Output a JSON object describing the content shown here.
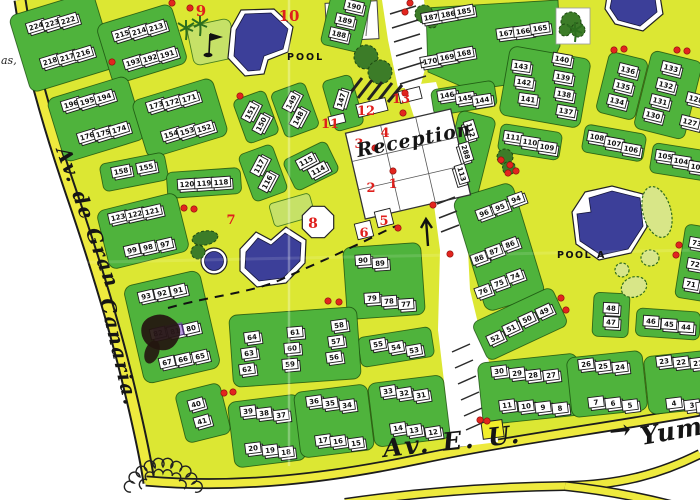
{
  "map": {
    "labels": [
      {
        "t": "POOL",
        "x": 287,
        "y": 60,
        "s": 9.5,
        "r": 0,
        "c": "print",
        "ls": 2
      },
      {
        "t": "POOL A",
        "x": 557,
        "y": 258,
        "s": 9.5,
        "r": 0,
        "c": "print",
        "ls": 1.5
      },
      {
        "t": "Av. de Gran",
        "x": 56,
        "y": 150,
        "s": 20,
        "r": 70,
        "c": "hand",
        "ls": 2
      },
      {
        "t": "Canaria.",
        "x": 100,
        "y": 300,
        "s": 20,
        "r": 77,
        "c": "hand",
        "ls": 2
      },
      {
        "t": "Reception",
        "x": 358,
        "y": 157,
        "s": 19,
        "r": -11,
        "c": "hand",
        "ls": 1
      },
      {
        "t": "Av. E. U.",
        "x": 384,
        "y": 457,
        "s": 25,
        "r": -6,
        "c": "hand",
        "ls": 3
      },
      {
        "t": "Yumbo",
        "x": 642,
        "y": 445,
        "s": 25,
        "r": -10,
        "c": "hand",
        "ls": 1
      },
      {
        "t": "→",
        "x": 610,
        "y": 440,
        "s": 26,
        "r": -6,
        "c": "hand",
        "ls": 0
      },
      {
        "t": "as,",
        "x": 1,
        "y": 64,
        "s": 11,
        "r": 0,
        "c": "print-it",
        "ls": 0
      }
    ],
    "red_numbers": [
      {
        "t": "1",
        "x": 393,
        "y": 188,
        "s": 13
      },
      {
        "t": "2",
        "x": 371,
        "y": 192,
        "s": 13
      },
      {
        "t": "3",
        "x": 359,
        "y": 148,
        "s": 13
      },
      {
        "t": "4",
        "x": 385,
        "y": 137,
        "s": 13
      },
      {
        "t": "5",
        "x": 384,
        "y": 225,
        "s": 13
      },
      {
        "t": "6",
        "x": 364,
        "y": 237,
        "s": 13
      },
      {
        "t": "7",
        "x": 231,
        "y": 224,
        "s": 13
      },
      {
        "t": "8",
        "x": 313,
        "y": 228,
        "s": 14
      },
      {
        "t": "9",
        "x": 201,
        "y": 16,
        "s": 15
      },
      {
        "t": "10",
        "x": 289,
        "y": 21,
        "s": 15
      },
      {
        "t": "11",
        "x": 330,
        "y": 128,
        "s": 13
      },
      {
        "t": "12",
        "x": 366,
        "y": 115,
        "s": 13
      },
      {
        "t": "13",
        "x": 401,
        "y": 103,
        "s": 13
      }
    ],
    "red_dots": [
      [
        172,
        3
      ],
      [
        190,
        8
      ],
      [
        405,
        12
      ],
      [
        410,
        3
      ],
      [
        112,
        62
      ],
      [
        240,
        96
      ],
      [
        614,
        50
      ],
      [
        624,
        49
      ],
      [
        677,
        50
      ],
      [
        687,
        51
      ],
      [
        405,
        93
      ],
      [
        433,
        205
      ],
      [
        398,
        228
      ],
      [
        375,
        148
      ],
      [
        393,
        171
      ],
      [
        403,
        113
      ],
      [
        501,
        160
      ],
      [
        510,
        165
      ],
      [
        508,
        173
      ],
      [
        516,
        171
      ],
      [
        184,
        208
      ],
      [
        194,
        209
      ],
      [
        328,
        301
      ],
      [
        339,
        302
      ],
      [
        450,
        254
      ],
      [
        561,
        298
      ],
      [
        566,
        310
      ],
      [
        679,
        245
      ],
      [
        676,
        255
      ],
      [
        224,
        393
      ],
      [
        233,
        392
      ],
      [
        480,
        420
      ],
      [
        487,
        421
      ]
    ],
    "buildings": [
      [
        "224",
        36,
        26,
        -17
      ],
      [
        "223",
        52,
        23,
        -17
      ],
      [
        "222",
        68,
        20,
        -17
      ],
      [
        "218",
        50,
        61,
        -17
      ],
      [
        "217",
        67,
        57,
        -17
      ],
      [
        "216",
        83,
        53,
        -17
      ],
      [
        "215",
        122,
        34,
        -17
      ],
      [
        "214",
        139,
        31,
        -17
      ],
      [
        "213",
        156,
        27,
        -17
      ],
      [
        "193",
        133,
        62,
        -17
      ],
      [
        "192",
        150,
        58,
        -17
      ],
      [
        "191",
        167,
        54,
        -17
      ],
      [
        "196",
        71,
        104,
        -17
      ],
      [
        "195",
        87,
        101,
        -17
      ],
      [
        "194",
        104,
        97,
        -17
      ],
      [
        "176",
        87,
        136,
        -17
      ],
      [
        "175",
        103,
        133,
        -17
      ],
      [
        "174",
        119,
        129,
        -17
      ],
      [
        "173",
        156,
        105,
        -17
      ],
      [
        "172",
        172,
        102,
        -17
      ],
      [
        "171",
        189,
        98,
        -17
      ],
      [
        "154",
        171,
        134,
        -17
      ],
      [
        "153",
        187,
        131,
        -17
      ],
      [
        "152",
        204,
        128,
        -17
      ],
      [
        "158",
        121,
        171,
        -11
      ],
      [
        "155",
        146,
        167,
        -11
      ],
      [
        "120",
        187,
        184,
        -4
      ],
      [
        "119",
        204,
        183,
        -4
      ],
      [
        "118",
        221,
        182,
        -4
      ],
      [
        "123",
        118,
        217,
        -13
      ],
      [
        "122",
        135,
        214,
        -13
      ],
      [
        "121",
        152,
        211,
        -13
      ],
      [
        "99",
        132,
        250,
        -13
      ],
      [
        "98",
        148,
        247,
        -13
      ],
      [
        "97",
        165,
        244,
        -13
      ],
      [
        "93",
        146,
        296,
        -13
      ],
      [
        "92",
        162,
        293,
        -13
      ],
      [
        "91",
        178,
        290,
        -13
      ],
      [
        "82",
        158,
        333,
        -13
      ],
      [
        "81",
        175,
        331,
        -13
      ],
      [
        "80",
        191,
        328,
        -13
      ],
      [
        "67",
        167,
        362,
        -13
      ],
      [
        "66",
        183,
        359,
        -13
      ],
      [
        "65",
        200,
        356,
        -13
      ],
      [
        "40",
        196,
        404,
        -16
      ],
      [
        "41",
        202,
        421,
        -16
      ],
      [
        "151",
        250,
        112,
        -62
      ],
      [
        "150",
        261,
        124,
        -62
      ],
      [
        "149",
        291,
        102,
        -62
      ],
      [
        "148",
        298,
        118,
        -62
      ],
      [
        "147",
        341,
        100,
        -73
      ],
      [
        "117",
        259,
        166,
        -62
      ],
      [
        "116",
        267,
        182,
        -62
      ],
      [
        "115",
        306,
        161,
        -28
      ],
      [
        "114",
        318,
        170,
        -28
      ],
      [
        "190",
        354,
        6,
        13
      ],
      [
        "189",
        345,
        20,
        13
      ],
      [
        "188",
        339,
        34,
        13
      ],
      [
        "187",
        431,
        17,
        -10
      ],
      [
        "186",
        448,
        14,
        -10
      ],
      [
        "185",
        464,
        11,
        -10
      ],
      [
        "167",
        506,
        33,
        -8
      ],
      [
        "166",
        523,
        31,
        -8
      ],
      [
        "165",
        540,
        28,
        -8
      ],
      [
        "170",
        430,
        61,
        -10
      ],
      [
        "169",
        447,
        57,
        -10
      ],
      [
        "168",
        464,
        53,
        -10
      ],
      [
        "143",
        521,
        66,
        8
      ],
      [
        "142",
        524,
        82,
        8
      ],
      [
        "141",
        528,
        99,
        8
      ],
      [
        "140",
        562,
        59,
        10
      ],
      [
        "139",
        563,
        77,
        10
      ],
      [
        "138",
        564,
        94,
        10
      ],
      [
        "137",
        566,
        111,
        10
      ],
      [
        "146",
        447,
        95,
        -9
      ],
      [
        "145",
        465,
        98,
        -9
      ],
      [
        "144",
        482,
        100,
        -9
      ],
      [
        "136",
        628,
        70,
        14
      ],
      [
        "135",
        623,
        86,
        14
      ],
      [
        "134",
        617,
        101,
        14
      ],
      [
        "133",
        671,
        68,
        14
      ],
      [
        "132",
        666,
        85,
        14
      ],
      [
        "131",
        660,
        101,
        14
      ],
      [
        "130",
        653,
        115,
        14
      ],
      [
        "128",
        696,
        99,
        14
      ],
      [
        "127",
        690,
        122,
        14
      ],
      [
        "111",
        513,
        137,
        9
      ],
      [
        "110",
        530,
        142,
        9
      ],
      [
        "109",
        547,
        147,
        9
      ],
      [
        "112",
        471,
        130,
        73
      ],
      [
        "288",
        466,
        152,
        73
      ],
      [
        "113",
        462,
        174,
        73
      ],
      [
        "108",
        597,
        137,
        10
      ],
      [
        "107",
        614,
        143,
        10
      ],
      [
        "106",
        631,
        149,
        10
      ],
      [
        "105",
        665,
        156,
        9
      ],
      [
        "104",
        681,
        161,
        9
      ],
      [
        "103",
        698,
        167,
        9
      ],
      [
        "96",
        484,
        213,
        -20
      ],
      [
        "95",
        500,
        207,
        -20
      ],
      [
        "94",
        516,
        199,
        -20
      ],
      [
        "88",
        479,
        258,
        -20
      ],
      [
        "87",
        494,
        251,
        -20
      ],
      [
        "86",
        510,
        244,
        -20
      ],
      [
        "76",
        483,
        291,
        -20
      ],
      [
        "75",
        499,
        283,
        -20
      ],
      [
        "74",
        515,
        276,
        -20
      ],
      [
        "90",
        363,
        260,
        -4
      ],
      [
        "89",
        380,
        263,
        -4
      ],
      [
        "79",
        372,
        298,
        -4
      ],
      [
        "78",
        389,
        301,
        -4
      ],
      [
        "77",
        406,
        304,
        -4
      ],
      [
        "52",
        495,
        338,
        -25
      ],
      [
        "51",
        511,
        328,
        -25
      ],
      [
        "50",
        527,
        319,
        -25
      ],
      [
        "49",
        544,
        311,
        -25
      ],
      [
        "55",
        378,
        344,
        -10
      ],
      [
        "54",
        396,
        347,
        -10
      ],
      [
        "53",
        414,
        350,
        -10
      ],
      [
        "48",
        611,
        308,
        3
      ],
      [
        "47",
        611,
        322,
        3
      ],
      [
        "46",
        651,
        321,
        4
      ],
      [
        "45",
        669,
        324,
        4
      ],
      [
        "44",
        686,
        327,
        4
      ],
      [
        "73",
        697,
        243,
        10
      ],
      [
        "72",
        695,
        264,
        10
      ],
      [
        "71",
        691,
        284,
        10
      ],
      [
        "64",
        252,
        337,
        -8
      ],
      [
        "63",
        249,
        353,
        -8
      ],
      [
        "62",
        247,
        369,
        -8
      ],
      [
        "61",
        295,
        332,
        -5
      ],
      [
        "60",
        292,
        348,
        -5
      ],
      [
        "59",
        290,
        364,
        -5
      ],
      [
        "58",
        339,
        325,
        -8
      ],
      [
        "57",
        336,
        341,
        -8
      ],
      [
        "56",
        334,
        357,
        -8
      ],
      [
        "39",
        248,
        411,
        -7
      ],
      [
        "38",
        264,
        413,
        -7
      ],
      [
        "37",
        281,
        415,
        -7
      ],
      [
        "20",
        253,
        448,
        -7
      ],
      [
        "19",
        270,
        450,
        -7
      ],
      [
        "18",
        286,
        452,
        -7
      ],
      [
        "36",
        314,
        401,
        -8
      ],
      [
        "35",
        330,
        403,
        -8
      ],
      [
        "34",
        347,
        405,
        -8
      ],
      [
        "17",
        323,
        440,
        -8
      ],
      [
        "16",
        338,
        441,
        -8
      ],
      [
        "15",
        356,
        443,
        -8
      ],
      [
        "33",
        388,
        391,
        -9
      ],
      [
        "32",
        404,
        393,
        -9
      ],
      [
        "31",
        421,
        395,
        -9
      ],
      [
        "14",
        398,
        428,
        -9
      ],
      [
        "13",
        414,
        430,
        -9
      ],
      [
        "12",
        433,
        432,
        -9
      ],
      [
        "30",
        499,
        371,
        -7
      ],
      [
        "29",
        517,
        373,
        -7
      ],
      [
        "28",
        533,
        375,
        -7
      ],
      [
        "27",
        551,
        375,
        -7
      ],
      [
        "11",
        507,
        405,
        -7
      ],
      [
        "10",
        526,
        406,
        -7
      ],
      [
        "9",
        543,
        407,
        -7
      ],
      [
        "8",
        560,
        408,
        -7
      ],
      [
        "26",
        586,
        364,
        -7
      ],
      [
        "25",
        603,
        366,
        -7
      ],
      [
        "24",
        620,
        367,
        -7
      ],
      [
        "7",
        596,
        402,
        -7
      ],
      [
        "6",
        613,
        403,
        -7
      ],
      [
        "5",
        630,
        405,
        -7
      ],
      [
        "23",
        664,
        361,
        -7
      ],
      [
        "22",
        681,
        362,
        -7
      ],
      [
        "21",
        698,
        363,
        -7
      ],
      [
        "4",
        674,
        403,
        -7
      ],
      [
        "3",
        692,
        405,
        -7
      ],
      [
        "2",
        704,
        407,
        -7
      ]
    ]
  }
}
